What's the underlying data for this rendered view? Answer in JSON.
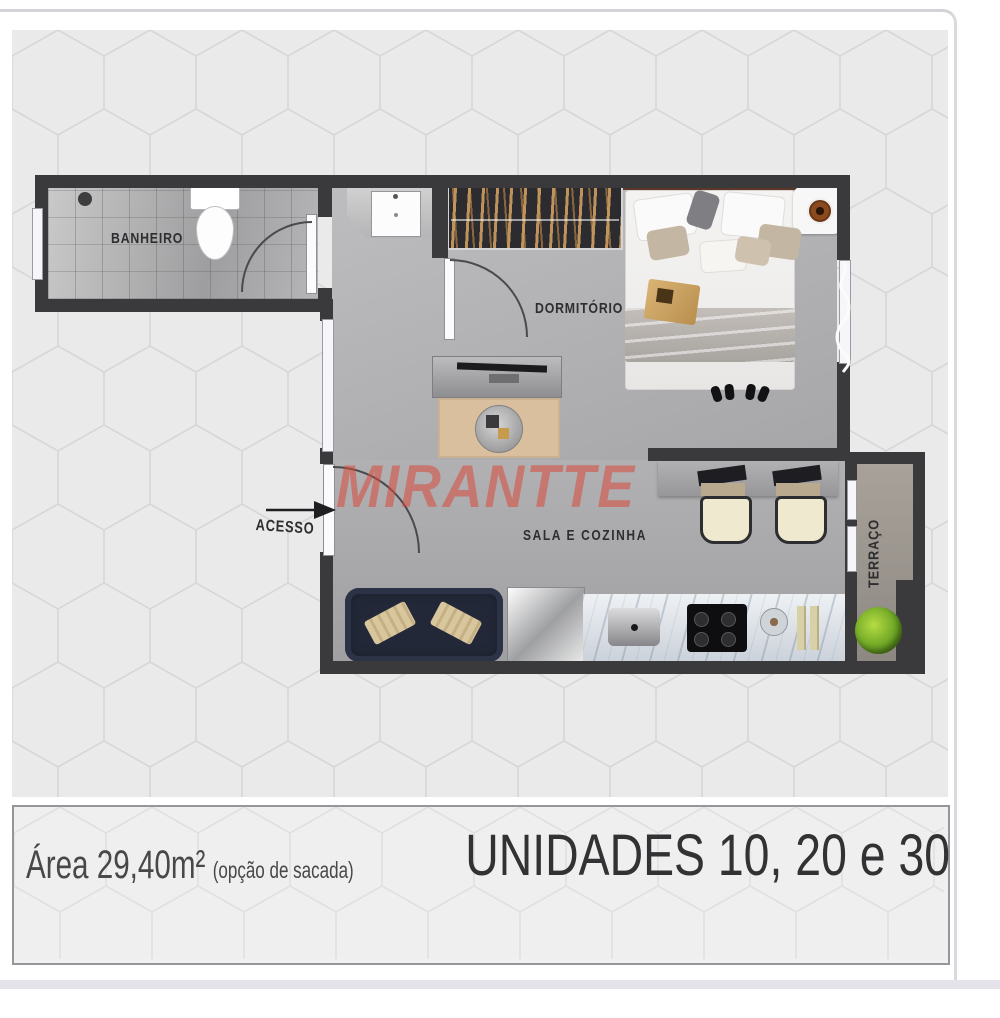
{
  "floor_plan": {
    "watermark_text": "MIRANTTE",
    "labels": {
      "bathroom": "BANHEIRO",
      "bedroom": "DORMITÓRIO",
      "living_kitchen": "SALA E COZINHA",
      "terrace": "TERRAÇO",
      "access": "ACESSO"
    },
    "colors": {
      "wall": "#3a3a3c",
      "watermark": "rgba(216,73,59,0.55)",
      "plant_green": "#6da525",
      "floor_gray": "#b2b2b4",
      "hex_background": "#eaeaea",
      "hex_line": "#d7d7d7"
    }
  },
  "footer": {
    "area_label": "Área 29,40m²",
    "area_note": "(opção de sacada)",
    "units_label": "UNIDADES 10, 20 e 30"
  }
}
